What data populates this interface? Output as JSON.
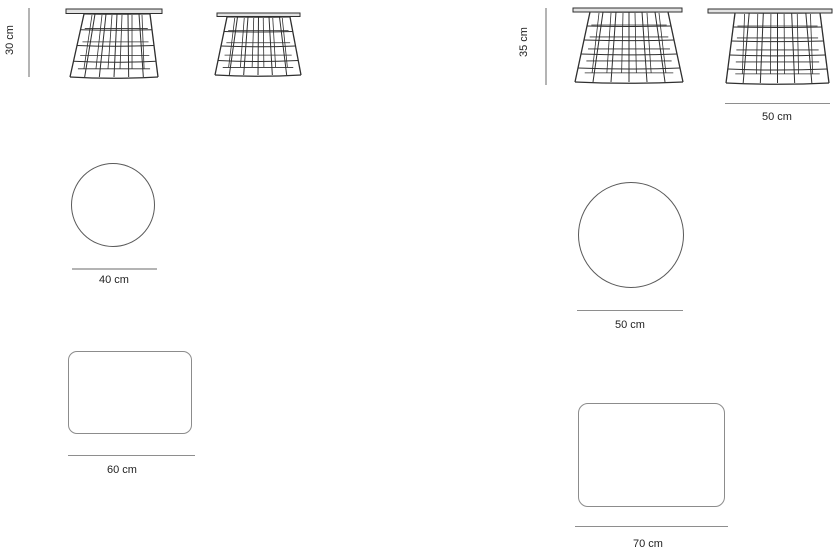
{
  "diagram": {
    "background": "#ffffff",
    "colors": {
      "wire": "#2f2f2f",
      "tabletop_fill": "#e3e3e3",
      "circle_stroke": "#5a5a5a",
      "rect_stroke": "#8c8c8c",
      "dimension_line_light": "#b4b4b4",
      "dimension_line_dark": "#8e8e8e",
      "label_text": "#1f1f1f"
    },
    "variants": [
      {
        "id": "small",
        "height_label": "30 cm",
        "top_diameter_label": "40 cm",
        "rect_width_label": "60 cm"
      },
      {
        "id": "large",
        "height_label": "35 cm",
        "table_width_label": "50 cm",
        "top_diameter_label": "50 cm",
        "rect_width_label": "70 cm"
      }
    ]
  }
}
